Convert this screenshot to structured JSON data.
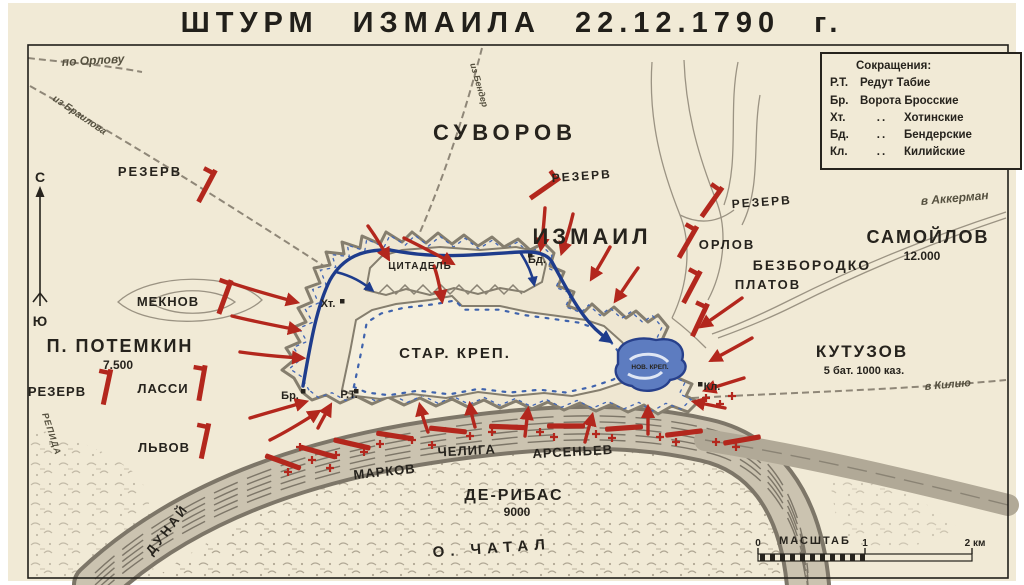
{
  "title": "ШТУРМ  ИЗМАИЛА  22.12.1790 г.",
  "legend": {
    "heading": "Сокращения:",
    "rows": [
      {
        "abbr": "Р.Т.",
        "ditto": "",
        "name": "Редут Табие"
      },
      {
        "abbr": "Бр.",
        "ditto": "",
        "name": "Ворота Бросские"
      },
      {
        "abbr": "Хт.",
        "ditto": "..",
        "name": "Хотинские"
      },
      {
        "abbr": "Бд.",
        "ditto": "..",
        "name": "Бендерские"
      },
      {
        "abbr": "Кл.",
        "ditto": "..",
        "name": "Килийские"
      }
    ]
  },
  "compass": {
    "north": "С",
    "south": "Ю"
  },
  "forces": {
    "suvorov": "СУВОРОВ",
    "izmail": "ИЗМАИЛ",
    "reserve_left": "РЕЗЕРВ",
    "reserve_center": "РЕЗЕРВ",
    "reserve_right": "РЕЗЕРВ",
    "reserve_southwest": "РЕЗЕРВ",
    "meknov": "МЕКНОВ",
    "potemkin": "П. ПОТЕМКИН",
    "potemkin_strength": "7.500",
    "lassi": "ЛАССИ",
    "lvov": "ЛЬВОВ",
    "orlov": "ОРЛОВ",
    "bezborodko": "БЕЗБОРОДКО",
    "platov": "ПЛАТОВ",
    "samoilov": "САМОЙЛОВ",
    "samoilov_strength": "12.000",
    "kutuzov": "КУТУЗОВ",
    "kutuzov_strength": "5 бат. 1000 каз.",
    "markov": "МАРКОВ",
    "cheliga": "ЧЕЛИГА",
    "arseniev": "АРСЕНЬЕВ",
    "deribas": "ДЕ-РИБАС",
    "deribas_strength": "9000"
  },
  "fortress": {
    "citadel": "ЦИТАДЕЛЬ",
    "old_fort": "СТАР. КРЕП.",
    "new_fort": "НОВ. КРЕП.",
    "gates": {
      "ht": "Хт.",
      "bd": "Бд.",
      "br": "Бр.",
      "rt": "Р.Т.",
      "kl": "Кл."
    }
  },
  "geography": {
    "danube": "ДУНАЙ",
    "chatal_island": "О. ЧАТАЛ",
    "repida": "РЕПИДА"
  },
  "routes": {
    "po_orlovu": "по Орлову",
    "iz_brailova": "из Браилова",
    "iz_bender": "из Бендер",
    "v_akkerman": "в Аккерман",
    "v_kiliyu": "в Килию"
  },
  "scale": {
    "label": "МАСШТАБ",
    "tick0": "0",
    "tick1": "1",
    "tick2": "2 км"
  },
  "colors": {
    "paper": "#f1ead6",
    "ink": "#26231d",
    "red": "#b3271d",
    "navy": "#1e3c8c",
    "fort_blue": "#4a6cb3",
    "terrain": "#9b9383"
  }
}
